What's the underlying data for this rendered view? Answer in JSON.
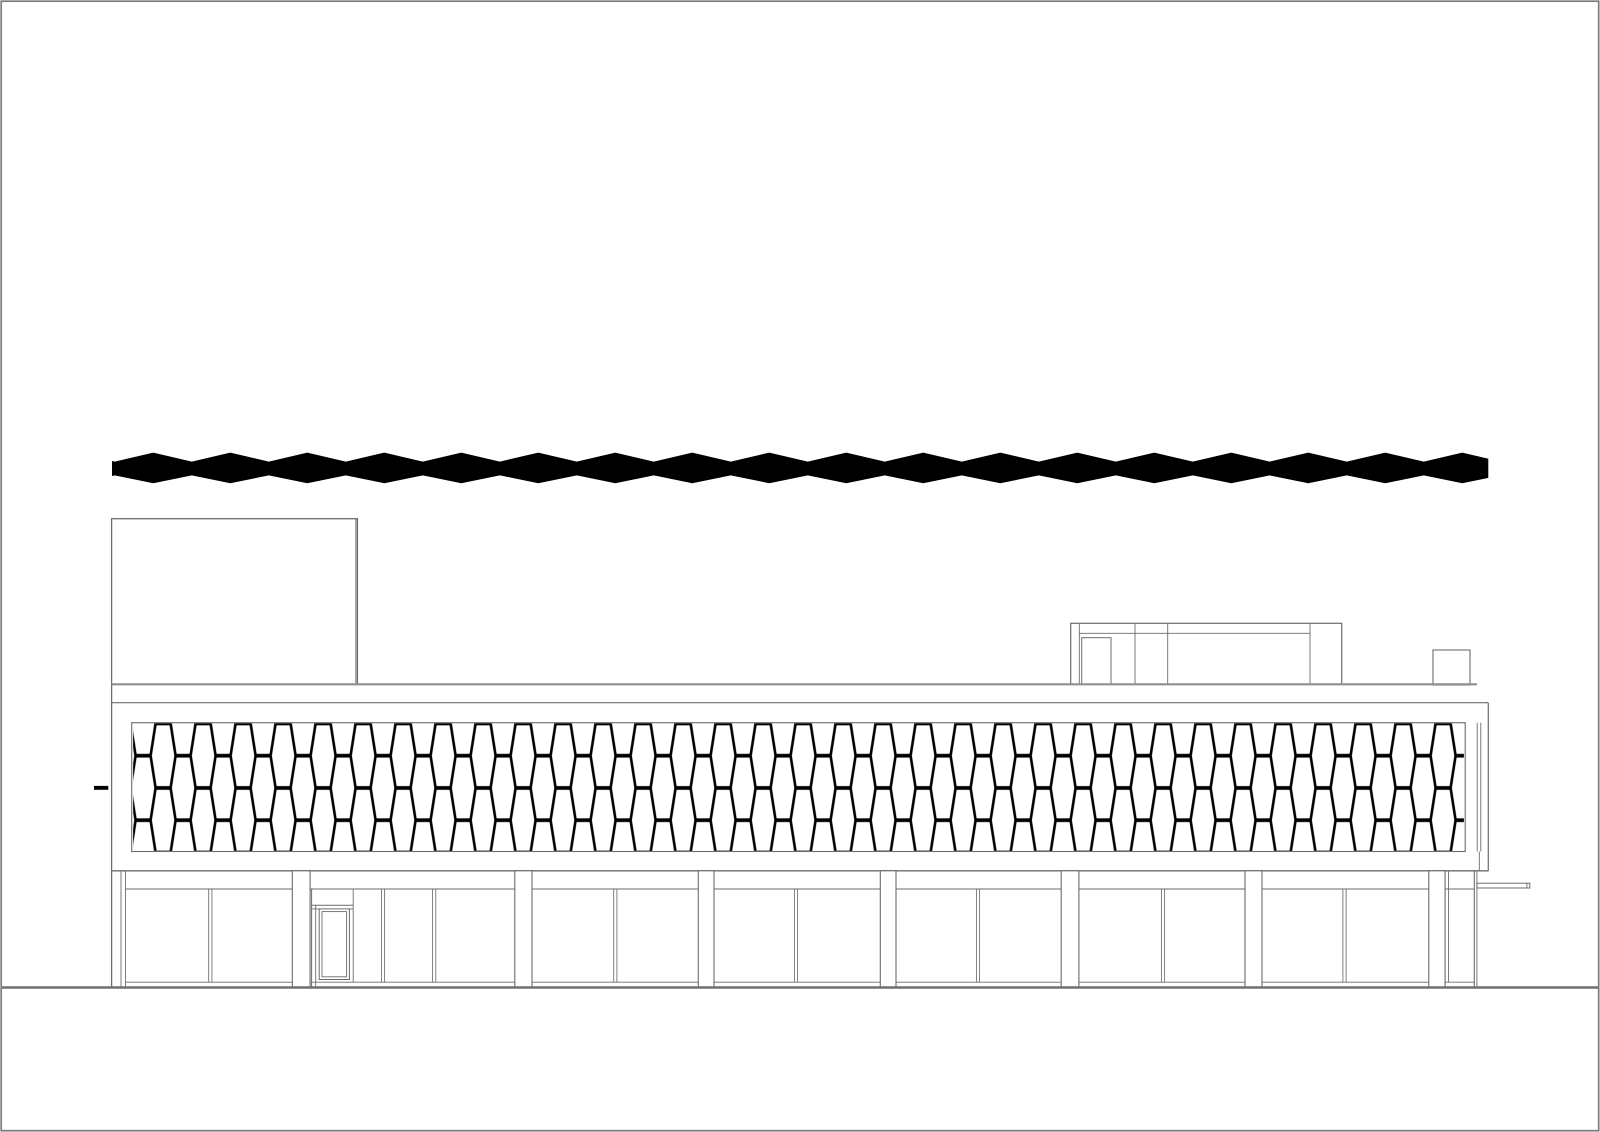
{
  "title": "building-elevation-line-drawing",
  "canvas": {
    "width": 1600,
    "height": 1132,
    "background": "#ffffff"
  },
  "colors": {
    "ink": "#000000",
    "line": "#6b6b6b",
    "soft": "#8e8e8e",
    "ground": "#6f6f6f",
    "border": "#7b7b7b",
    "white": "#ffffff"
  },
  "page_border": {
    "rects": [
      [
        1.2,
        1.2,
        1597.5,
        1129.5,
        1.7,
        "none",
        "border"
      ]
    ]
  },
  "zigzag_band": {
    "x_clip": [
      112,
      1488.3
    ],
    "first_peak_x": 153.3,
    "period": 77,
    "peak_count": 18,
    "y_peak_top": 452.6,
    "y_junction_top": 461.6,
    "y_junction_bottom": 475.4,
    "y_peak_bottom": 483.2,
    "fill": "ink"
  },
  "rooftop_box_left": {
    "rects": [
      [
        111.6,
        518.7,
        245.8,
        165.6,
        1.3
      ]
    ],
    "vlines": [
      [
        355.9,
        518.7,
        684.2,
        1
      ]
    ]
  },
  "penthouse_right": {
    "rects": [
      [
        1070.7,
        623.3,
        271.0,
        61.0,
        1.2
      ],
      [
        1081.7,
        637.7,
        29.3,
        46.5,
        1.0
      ]
    ],
    "vlines": [
      [
        1079.3,
        623.3,
        684.2,
        0.9
      ],
      [
        1135.0,
        623.3,
        684.2,
        0.9
      ],
      [
        1167.7,
        623.3,
        684.2,
        0.9
      ],
      [
        1310.0,
        623.3,
        684.2,
        0.9
      ]
    ],
    "hlines": [
      [
        633.3,
        1079.3,
        1310.0,
        0.9
      ]
    ]
  },
  "rooftop_small_box": {
    "rects": [
      [
        1433.0,
        650.0,
        37.0,
        35.0,
        1.1
      ]
    ]
  },
  "roof_fascia": {
    "hlines": [
      [
        684.3,
        111.0,
        1477.0,
        2.2,
        "soft"
      ],
      [
        702.7,
        111.0,
        1488.3,
        1.1
      ]
    ],
    "vlines": [
      [
        1488.3,
        702.7,
        870.8,
        1.2
      ]
    ]
  },
  "hex_screen_band": {
    "rects": [
      [
        131.7,
        722.7,
        1333.5,
        128.8,
        1.1
      ],
      [
        94.0,
        785.9,
        14.3,
        3.9,
        0,
        "ink"
      ]
    ],
    "vlines": [
      [
        1477.2,
        722.7,
        851.5,
        0.9
      ],
      [
        1480.8,
        722.7,
        851.5,
        0.9
      ]
    ],
    "pattern": {
      "area": [
        133.1,
        723.3,
        1330.8,
        127.6
      ],
      "tile_w": 40,
      "tile_h": 64.5,
      "origin_x": 133.1,
      "origin_y": 691.2,
      "bar_half_len": 7.5,
      "bulge_half": 12.5,
      "bar_stroke": 3.8,
      "diag_stroke": 2.6,
      "stroke": "ink"
    }
  },
  "floor_slab_band": {
    "hlines": [
      [
        870.8,
        111.0,
        1488.5,
        1.4
      ]
    ],
    "vlines": [
      [
        1479.3,
        851.5,
        870.8,
        0.9
      ]
    ]
  },
  "storefront": {
    "vlines": [
      [
        111.6,
        684.3,
        987.5,
        1.3
      ],
      [
        121.0,
        870.8,
        987.5,
        0.9
      ],
      [
        125.5,
        870.8,
        987.5,
        0.9
      ],
      [
        1448.5,
        870.8,
        982.2,
        0.9
      ],
      [
        1474.3,
        870.8,
        987.5,
        1.1
      ],
      [
        1476.9,
        870.8,
        987.5,
        0.9
      ]
    ],
    "hlines": [
      [
        889.0,
        125.5,
        1474.3,
        1.0
      ],
      [
        982.2,
        125.5,
        1474.3,
        0.9
      ]
    ],
    "mullions": {
      "centers_x": [
        210.3,
        434.2,
        615.3,
        796.0,
        978.0,
        1163.0,
        1344.5
      ],
      "gap": 3.2,
      "y1": 889.0,
      "y2": 982.2,
      "stroke_w": 0.85
    },
    "columns": {
      "rects": [
        [
          292.3,
          870.8,
          17.8,
          116.7,
          1.1,
          "white"
        ],
        [
          514.8,
          870.8,
          17.2,
          116.7,
          1.1,
          "white"
        ],
        [
          698.3,
          870.8,
          15.7,
          116.7,
          1.1,
          "white"
        ],
        [
          880.3,
          870.8,
          15.7,
          116.7,
          1.1,
          "white"
        ],
        [
          1061.2,
          870.8,
          17.7,
          116.7,
          1.1,
          "white"
        ],
        [
          1245.0,
          870.8,
          17.0,
          116.7,
          1.1,
          "white"
        ],
        [
          1428.8,
          870.8,
          16.3,
          116.7,
          1.1,
          "white"
        ]
      ]
    }
  },
  "entry_door": {
    "vlines": [
      [
        311.6,
        889.0,
        987.5,
        1.0
      ],
      [
        315.7,
        905.3,
        987.5,
        0.9
      ],
      [
        353.2,
        889.0,
        982.2,
        0.9
      ],
      [
        381.6,
        889.0,
        982.2,
        0.85
      ],
      [
        384.6,
        889.0,
        982.2,
        0.85
      ]
    ],
    "hlines": [
      [
        905.3,
        311.6,
        353.2,
        1.0
      ],
      [
        908.9,
        311.6,
        353.2,
        0.9
      ]
    ],
    "rects": [
      [
        319.2,
        908.9,
        30.2,
        70.6,
        1.0,
        "white"
      ],
      [
        322.0,
        911.6,
        24.6,
        65.2,
        0.9
      ]
    ]
  },
  "handrail": {
    "rects": [
      [
        1476.9,
        883.2,
        52.9,
        4.8,
        1.0
      ]
    ],
    "vlines": [
      [
        1526.9,
        883.2,
        888.0,
        0.9
      ]
    ]
  },
  "ground_line": {
    "hlines": [
      [
        987.5,
        2.0,
        1598.0,
        2.4,
        "ground"
      ]
    ]
  }
}
